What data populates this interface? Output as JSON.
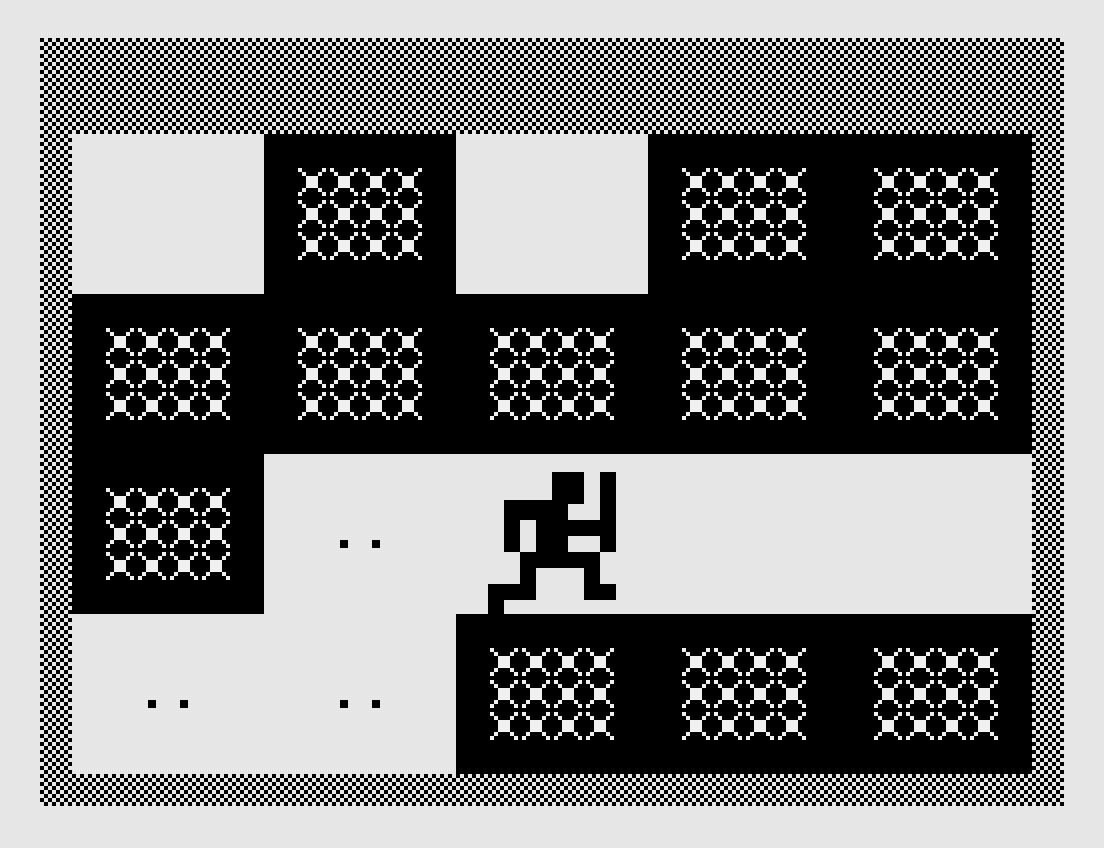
{
  "colors": {
    "page_background": "#e6e6e6",
    "ink": "#000000",
    "floor": "#e6e6e6",
    "lattice_dot": "#f0f0f0",
    "checker_light": "#e8e8e8"
  },
  "screen": {
    "width": 1024,
    "height": 768,
    "cols": 32,
    "rows": 24,
    "cell": 32,
    "pixel": 4,
    "offset_x": 40,
    "offset_y": 38
  },
  "border": {
    "pattern": "checkerboard",
    "check_size": 4,
    "regions": [
      {
        "col": 0,
        "row": 0,
        "w": 32,
        "h": 3
      },
      {
        "col": 0,
        "row": 23,
        "w": 32,
        "h": 1
      },
      {
        "col": 0,
        "row": 3,
        "w": 1,
        "h": 20
      },
      {
        "col": 31,
        "row": 3,
        "w": 1,
        "h": 20
      }
    ]
  },
  "walls": [
    {
      "col": 7,
      "row": 3,
      "w": 6,
      "h": 5
    },
    {
      "col": 19,
      "row": 3,
      "w": 12,
      "h": 5
    },
    {
      "col": 1,
      "row": 8,
      "w": 30,
      "h": 5
    },
    {
      "col": 1,
      "row": 13,
      "w": 6,
      "h": 5
    },
    {
      "col": 13,
      "row": 18,
      "w": 18,
      "h": 5
    }
  ],
  "cross_glyph": {
    "cell_inset": 2,
    "unit": 4,
    "rects": [
      [
        0,
        0,
        1,
        1
      ],
      [
        6,
        0,
        1,
        1
      ],
      [
        1,
        1,
        1,
        1
      ],
      [
        5,
        1,
        1,
        1
      ],
      [
        2,
        2,
        3,
        3
      ],
      [
        1,
        5,
        1,
        1
      ],
      [
        5,
        5,
        1,
        1
      ],
      [
        0,
        6,
        1,
        1
      ],
      [
        6,
        6,
        1,
        1
      ]
    ]
  },
  "cross_groups": {
    "tile_cols": 4,
    "tile_rows": 3,
    "positions": [
      {
        "col": 8,
        "row": 4
      },
      {
        "col": 20,
        "row": 4
      },
      {
        "col": 26,
        "row": 4
      },
      {
        "col": 2,
        "row": 9
      },
      {
        "col": 8,
        "row": 9
      },
      {
        "col": 14,
        "row": 9
      },
      {
        "col": 20,
        "row": 9
      },
      {
        "col": 26,
        "row": 9
      },
      {
        "col": 2,
        "row": 14
      },
      {
        "col": 14,
        "row": 19
      },
      {
        "col": 20,
        "row": 19
      },
      {
        "col": 26,
        "row": 19
      }
    ]
  },
  "eyes_pairs": {
    "dot_size": 8,
    "gap": 32,
    "positions": [
      {
        "x": 300,
        "y": 502
      },
      {
        "x": 108,
        "y": 662
      },
      {
        "x": 300,
        "y": 662
      }
    ]
  },
  "player_sprite": {
    "x": 448,
    "y": 434,
    "pixel": 4,
    "bitmap": [
      "................XXXXXXXX....XXXX",
      "................XXXXXXXX....XXXX",
      "................XXXXXXXX....XXXX",
      "................XXXXXXXX....XXXX",
      "................XXXXXXXX....XXXX",
      "................XXXXXXXX....XXXX",
      "................XXXXXXXX....XXXX",
      "....XXXXXXXXXXXXXXXXXXXX....XXXX",
      "....XXXXXXXXXXXXXXXX........XXXX",
      "....XXXXXXXXXXXXXXXX........XXXX",
      "....XXXXXXXXXXXXXXXX........XXXX",
      "....XXXXXXXXXXXXXXXX........XXXX",
      "....XXXX....XXXXXXXXXXXXXXXXXXXX",
      "....XXXX....XXXXXXXXXXXXXXXXXXXX",
      "....XXXX....XXXXXXXXXXXXXXXXXXXX",
      "....XXXX....XXXXXXXXXXXXXXXXXXXX",
      "....XXXX....XXXXXXXX........XXXX",
      "....XXXX....XXXXXXXX........XXXX",
      "....XXXX....XXXXXXXX........XXXX",
      "....XXXX....XXXXXXXX........XXXX",
      "........XXXXXXXXXXXXXXXXXXXX....",
      "........XXXXXXXXXXXXXXXXXXXX....",
      "........XXXXXXXXXXXXXXXXXXXX....",
      "........XXXXXXXXXXXXXXXXXXXX....",
      "........XXXX............XXXX....",
      "........XXXX............XXXX....",
      "........XXXX............XXXX....",
      "........XXXX............XXXX....",
      "XXXXXXXXXXXX............XXXXXXXX",
      "XXXXXXXXXXXX............XXXXXXXX",
      "XXXXXXXXXXXX............XXXXXXXX",
      "XXXXXXXXXXXX............XXXXXXXX",
      "XXXX............................",
      "XXXX............................",
      "XXXX............................",
      "XXXX............................"
    ]
  }
}
